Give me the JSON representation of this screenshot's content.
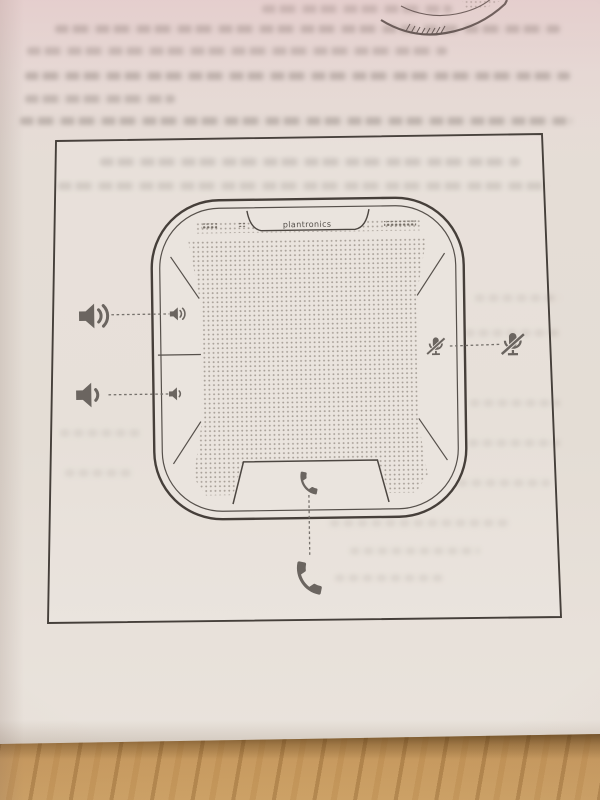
{
  "device_diagram": {
    "brand_label": "plantronics",
    "device": "speakerphone-top-view",
    "controls": [
      {
        "name": "volume-up",
        "icon": "volume-up-icon",
        "position": "left-top",
        "connector": "dashed"
      },
      {
        "name": "volume-down",
        "icon": "volume-down-icon",
        "position": "left-bottom",
        "connector": "dashed"
      },
      {
        "name": "mute",
        "icon": "mic-mute-icon",
        "position": "right",
        "connector": "dashed"
      },
      {
        "name": "call",
        "icon": "phone-handset-icon",
        "position": "bottom",
        "connector": "dashed"
      }
    ]
  },
  "colors": {
    "paper": "#e6dfd8",
    "ink": "#48423c",
    "icon_gray": "#6b655f",
    "grille_dot": "#a39a91",
    "wood": "#c79a60",
    "wood_shadow": "#3a240c"
  }
}
